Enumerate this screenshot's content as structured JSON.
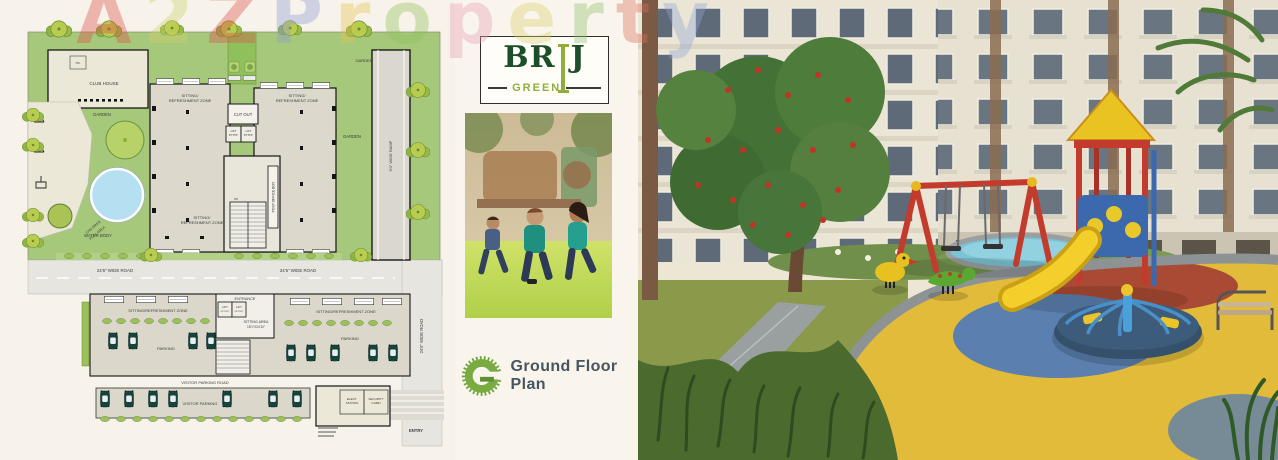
{
  "watermark": {
    "text": "A2Z Property",
    "letters": [
      {
        "ch": "A",
        "color": "#df5148"
      },
      {
        "ch": "2",
        "color": "#cfd26a"
      },
      {
        "ch": "Z",
        "color": "#df5148"
      },
      {
        "ch": "P",
        "color": "#8d9bd6"
      },
      {
        "ch": "r",
        "color": "#e4c34e"
      },
      {
        "ch": "o",
        "color": "#90bf5a"
      },
      {
        "ch": "p",
        "color": "#e79fb4"
      },
      {
        "ch": "e",
        "color": "#d9d06b"
      },
      {
        "ch": "r",
        "color": "#8fc06a"
      },
      {
        "ch": "t",
        "color": "#dd6f5e"
      },
      {
        "ch": "y",
        "color": "#92a4d4"
      }
    ]
  },
  "logo": {
    "brand_left": "BR",
    "brand_i": "I",
    "brand_right": "J",
    "sub": "GREEN",
    "colors": {
      "dark_green": "#1c4e2a",
      "olive": "#8fae3b"
    }
  },
  "caption": {
    "label": "Ground Floor Plan",
    "color": "#475560"
  },
  "plan": {
    "colors": {
      "garden": "#a6c87b",
      "water": "#b5e0f2",
      "building": "#dcd9cc",
      "road": "#e7e5df"
    },
    "labels": {
      "club_house": "CLUB HOUSE",
      "toilet": "TOI.",
      "garden": "GARDEN",
      "children_line1": "CHILDREN",
      "children_line2": "PLAY AREA",
      "water_body": "WATER BODY",
      "sitting_line1": "SITTING/",
      "sitting_line2": "REFRESHMENT ZONE",
      "sitting_single": "SITTING/REFRESHMENT ZONE",
      "cut_out": "CUT OUT",
      "lift": "LIFT",
      "lift_size": "5'6\"X5'6\"",
      "post_office_box": "POST OFFICE BOX",
      "ramp": "9'0\" WIDE RAMP",
      "road": "24'6\" WIDE ROAD",
      "entrance": "ENTRANCE",
      "sitting_area_line1": "SITTING AREA",
      "sitting_area_line2": "15'1\"X24'10\"",
      "parking": "PARKING",
      "visitor_parking_road": "VISITOR PARKING ROAD",
      "visitor_parking": "VISITOR PARKING",
      "elect_line1": "ELECT.",
      "elect_line2": "STATION",
      "security_line1": "SECURITY",
      "security_line2": "CABIN",
      "entry": "ENTRY",
      "up": "UP"
    }
  }
}
